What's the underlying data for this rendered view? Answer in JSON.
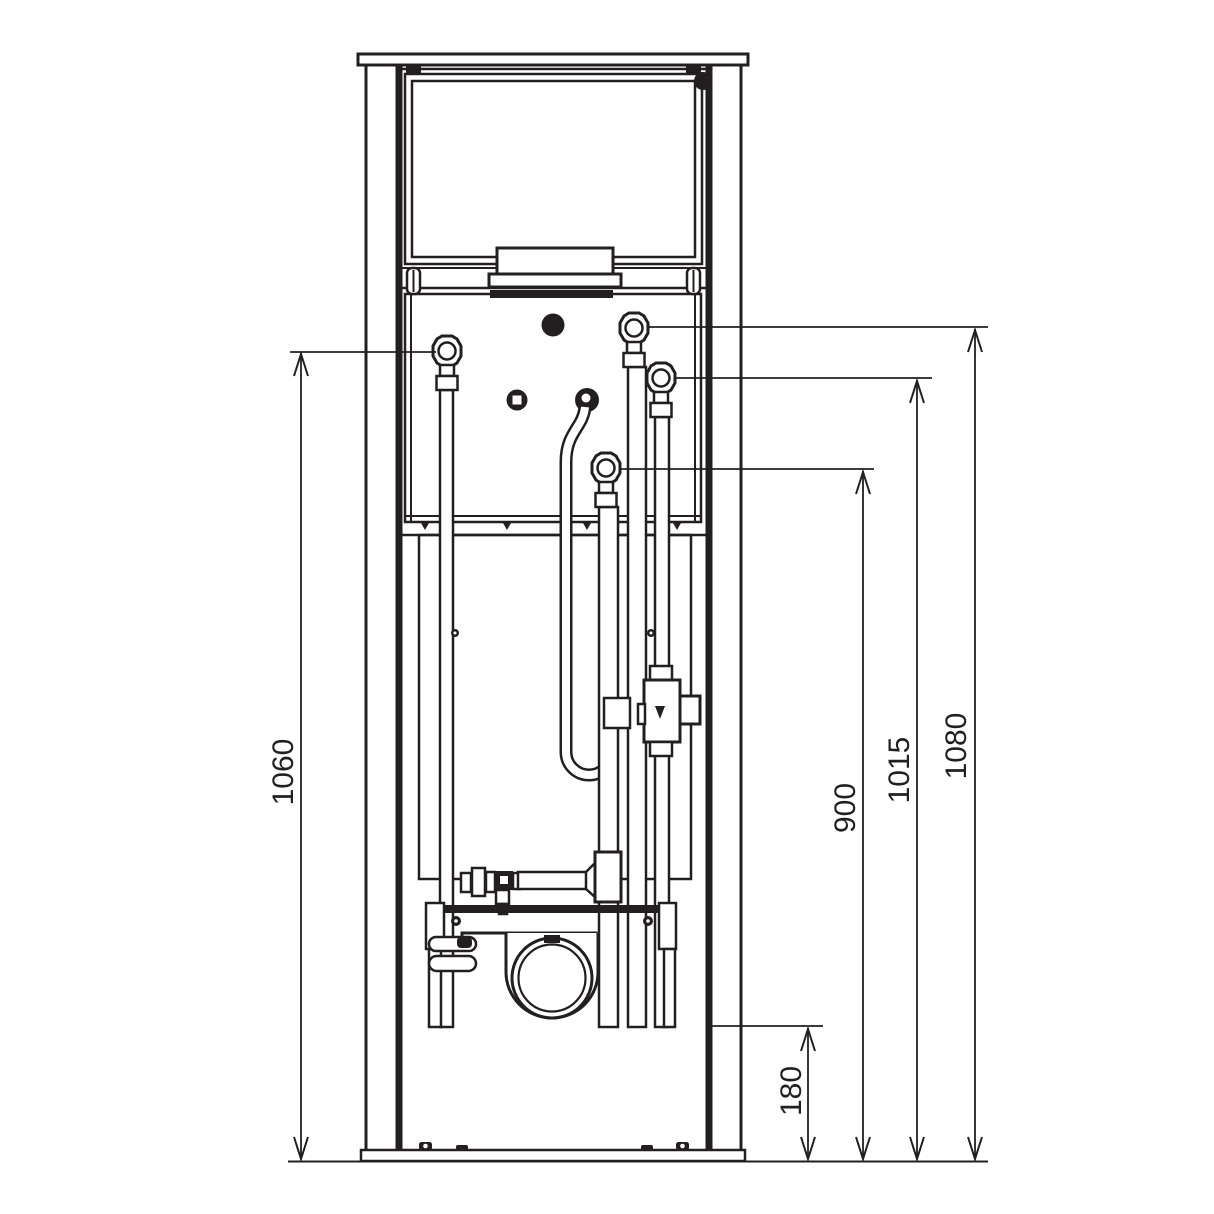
{
  "drawing": {
    "type": "technical-line-drawing",
    "subject": "in-wall-installation-frame-front-view",
    "colors": {
      "line": "#231f20",
      "background": "#ffffff"
    },
    "dimensions": {
      "left_height": "1060",
      "right_inner": "900",
      "right_middle": "1015",
      "right_outer": "1080",
      "bottom_offset": "180"
    }
  }
}
